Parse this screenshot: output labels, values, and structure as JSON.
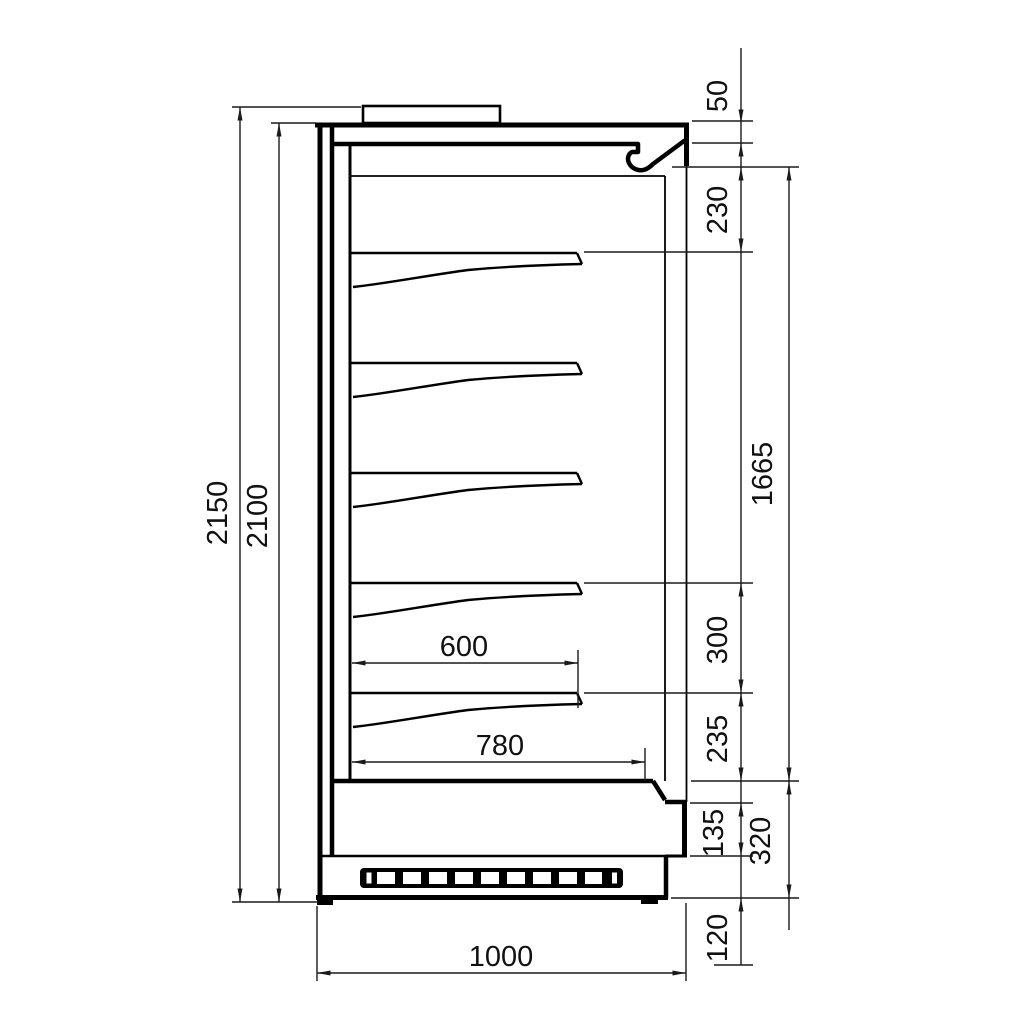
{
  "drawing": {
    "type": "technical-section-drawing",
    "subject": "open-front refrigerated display cabinet, side section",
    "background_color": "#ffffff",
    "line_color": "#000000",
    "dimensions": {
      "overall_height": "2150",
      "cabinet_height": "2100",
      "canopy_front_height": "50",
      "canopy_to_first_shelf": "230",
      "interior_height": "1665",
      "shelf_spacing": "300",
      "last_shelf_to_deck": "235",
      "step_height": "135",
      "base_height": "320",
      "plinth_height": "120",
      "shelf_depth": "600",
      "deck_depth": "780",
      "overall_depth": "1000"
    }
  }
}
